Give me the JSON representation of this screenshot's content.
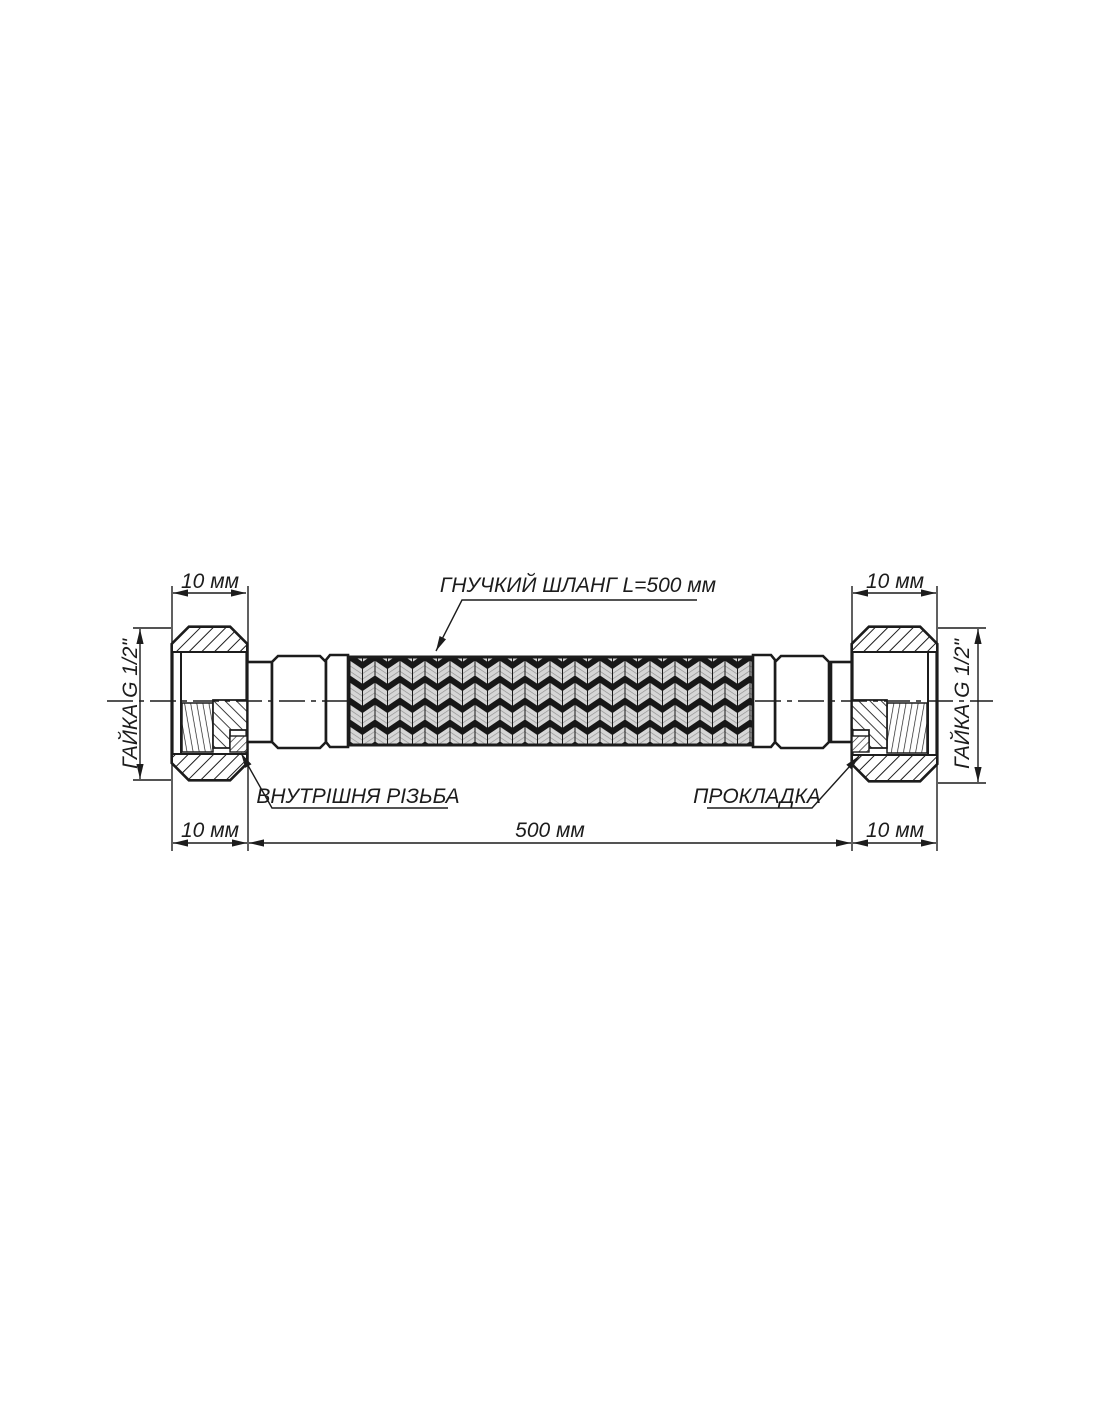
{
  "drawing": {
    "labels": {
      "hose": "ГНУЧКИЙ ШЛАНГ L=500 мм",
      "internal_thread": "ВНУТРІШНЯ РІЗЬБА",
      "gasket": "ПРОКЛАДКА",
      "left_nut": "ГАЙКА G 1/2\"",
      "right_nut": "ГАЙКА G 1/2\""
    },
    "dims": {
      "top_left": "10 мм",
      "top_right": "10 мм",
      "bottom_left": "10 мм",
      "bottom_center": "500 мм",
      "bottom_right": "10 мм"
    },
    "colors": {
      "line": "#1c1c1c",
      "background": "#ffffff",
      "braid_light": "#d6d6d6",
      "braid_gap": "#171717"
    }
  }
}
